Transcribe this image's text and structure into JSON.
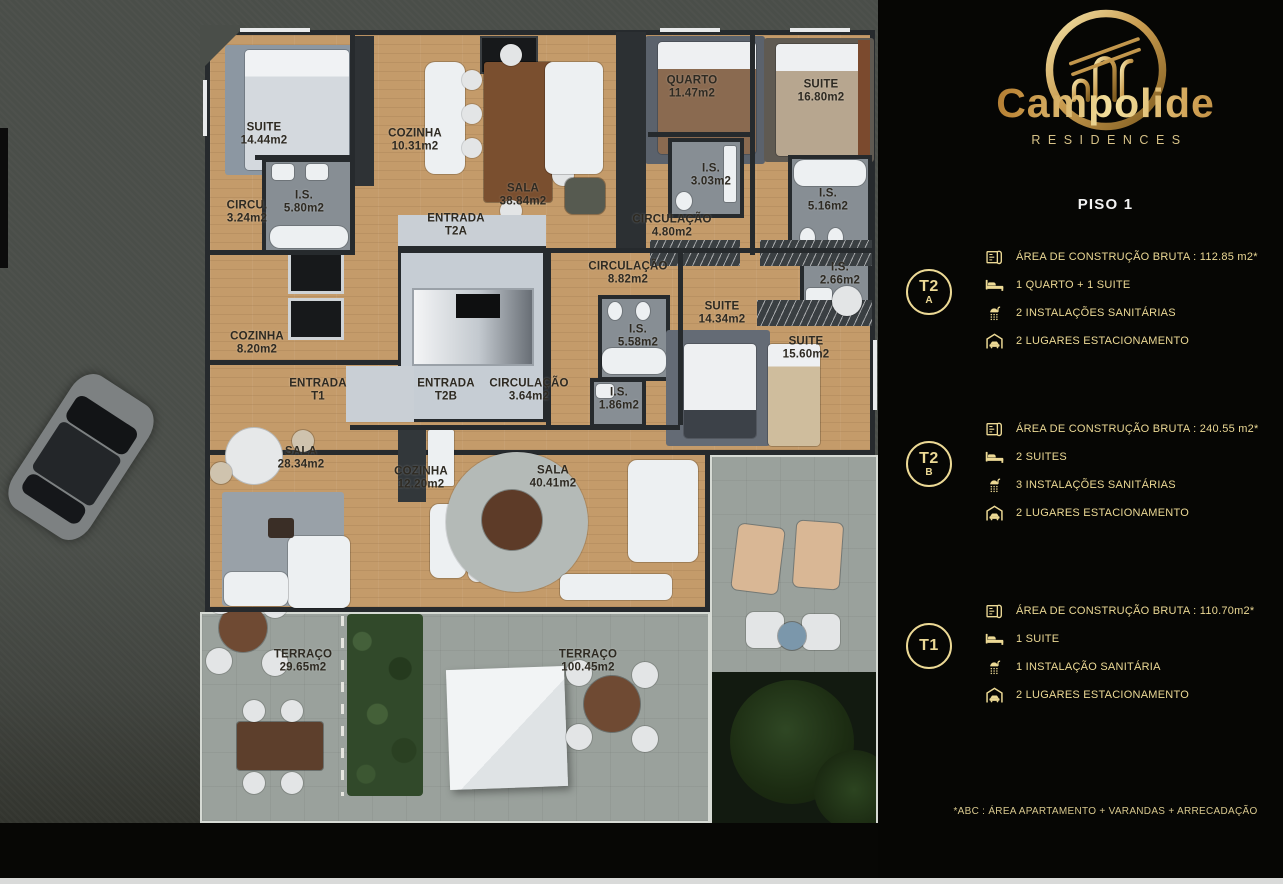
{
  "brand": {
    "name": "Campolide",
    "subtitle": "RESIDENCES"
  },
  "panel": {
    "floor_title": "PISO 1",
    "units": [
      {
        "id": "T2A",
        "badge": {
          "line1": "T2",
          "line2": "A"
        },
        "specs": [
          {
            "icon": "floorplan-icon",
            "text": "ÁREA DE CONSTRUÇÃO BRUTA :  112.85 m2*"
          },
          {
            "icon": "bed-icon",
            "text": "1 QUARTO + 1 SUITE"
          },
          {
            "icon": "shower-icon",
            "text": "2 INSTALAÇÕES SANITÁRIAS"
          },
          {
            "icon": "parking-icon",
            "text": "2 LUGARES ESTACIONAMENTO"
          }
        ]
      },
      {
        "id": "T2B",
        "badge": {
          "line1": "T2",
          "line2": "B"
        },
        "specs": [
          {
            "icon": "floorplan-icon",
            "text": "ÁREA DE CONSTRUÇÃO BRUTA :  240.55 m2*"
          },
          {
            "icon": "bed-icon",
            "text": "2 SUITES"
          },
          {
            "icon": "shower-icon",
            "text": "3 INSTALAÇÕES SANITÁRIAS"
          },
          {
            "icon": "parking-icon",
            "text": "2 LUGARES ESTACIONAMENTO"
          }
        ]
      },
      {
        "id": "T1",
        "badge": {
          "line1": "T1",
          "line2": ""
        },
        "specs": [
          {
            "icon": "floorplan-icon",
            "text": "ÁREA DE CONSTRUÇÃO BRUTA :  110.70m2*"
          },
          {
            "icon": "bed-icon",
            "text": "1 SUITE"
          },
          {
            "icon": "shower-icon",
            "text": "1 INSTALAÇÃO SANITÁRIA"
          },
          {
            "icon": "parking-icon",
            "text": "2 LUGARES ESTACIONAMENTO"
          }
        ]
      }
    ],
    "footnote": "*ABC :  ÁREA APARTAMENTO + VARANDAS + ARRECADAÇÃO"
  },
  "floorplan": {
    "rooms": [
      {
        "l1": "SUITE",
        "l2": "14.44m2",
        "x": 264,
        "y": 135
      },
      {
        "l1": "COZINHA",
        "l2": "10.31m2",
        "x": 415,
        "y": 141
      },
      {
        "l1": "QUARTO",
        "l2": "11.47m2",
        "x": 692,
        "y": 88
      },
      {
        "l1": "SUITE",
        "l2": "16.80m2",
        "x": 821,
        "y": 92
      },
      {
        "l1": "CIRCU.",
        "l2": "3.24m2",
        "x": 247,
        "y": 213
      },
      {
        "l1": "I.S.",
        "l2": "5.80m2",
        "x": 304,
        "y": 203
      },
      {
        "l1": "SALA",
        "l2": "38.84m2",
        "x": 523,
        "y": 196
      },
      {
        "l1": "I.S.",
        "l2": "3.03m2",
        "x": 711,
        "y": 176
      },
      {
        "l1": "I.S.",
        "l2": "5.16m2",
        "x": 828,
        "y": 201
      },
      {
        "l1": "ENTRADA",
        "l2": "T2A",
        "x": 456,
        "y": 226
      },
      {
        "l1": "CIRCULAÇÃO",
        "l2": "4.80m2",
        "x": 672,
        "y": 227
      },
      {
        "l1": "CIRCULAÇÃO",
        "l2": "8.82m2",
        "x": 628,
        "y": 274
      },
      {
        "l1": "I.S.",
        "l2": "2.66m2",
        "x": 840,
        "y": 275
      },
      {
        "l1": "SUITE",
        "l2": "14.34m2",
        "x": 722,
        "y": 314
      },
      {
        "l1": "I.S.",
        "l2": "5.58m2",
        "x": 638,
        "y": 337
      },
      {
        "l1": "SUITE",
        "l2": "15.60m2",
        "x": 806,
        "y": 349
      },
      {
        "l1": "COZINHA",
        "l2": "8.20m2",
        "x": 257,
        "y": 344
      },
      {
        "l1": "ENTRADA",
        "l2": "T1",
        "x": 318,
        "y": 391
      },
      {
        "l1": "ENTRADA",
        "l2": "T2B",
        "x": 446,
        "y": 391
      },
      {
        "l1": "CIRCULAÇÃO",
        "l2": "3.64m2",
        "x": 529,
        "y": 391
      },
      {
        "l1": "I.S.",
        "l2": "1.86m2",
        "x": 619,
        "y": 400
      },
      {
        "l1": "SALA",
        "l2": "28.34m2",
        "x": 301,
        "y": 459
      },
      {
        "l1": "COZINHA",
        "l2": "12.20m2",
        "x": 421,
        "y": 479
      },
      {
        "l1": "SALA",
        "l2": "40.41m2",
        "x": 553,
        "y": 478
      },
      {
        "l1": "TERRAÇO",
        "l2": "29.65m2",
        "x": 303,
        "y": 662
      },
      {
        "l1": "TERRAÇO",
        "l2": "100.45m2",
        "x": 588,
        "y": 662
      }
    ]
  },
  "colors": {
    "gold_accent": "#ecd995",
    "panel_background": "#060604",
    "wood_floor": "#c49b6a",
    "terrace_paving": "#9aa19c",
    "street": "#4a4e49"
  }
}
